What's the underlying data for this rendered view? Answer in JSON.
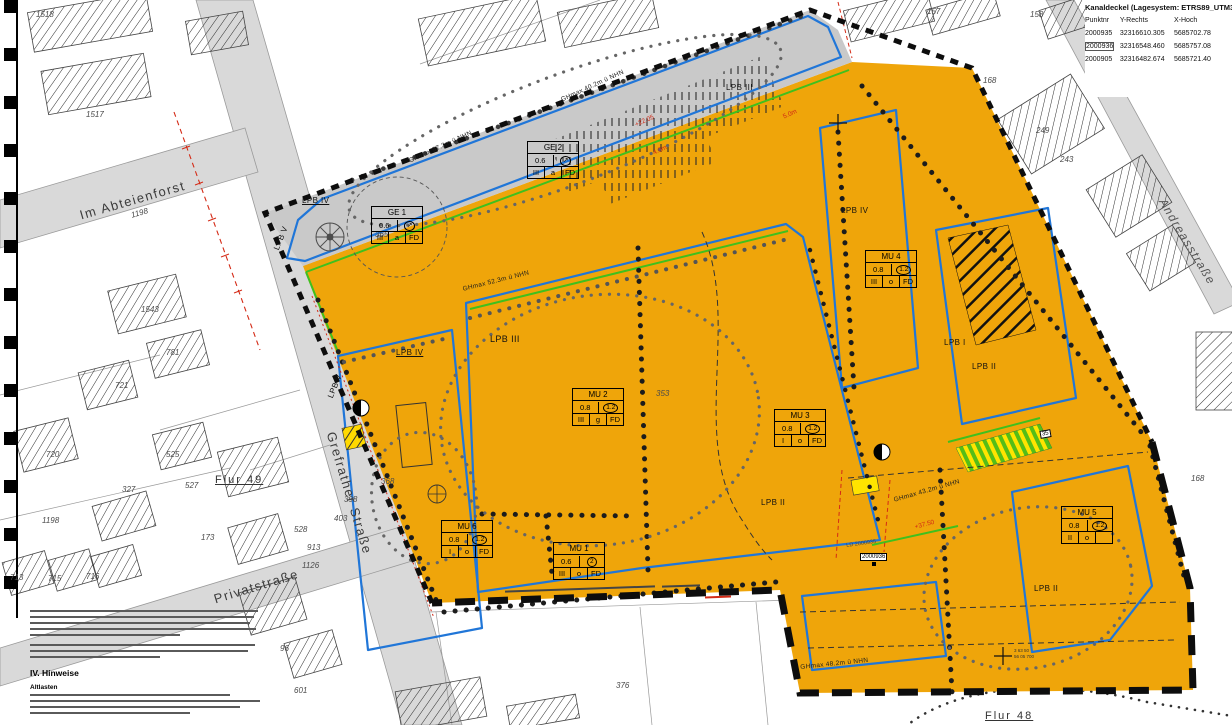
{
  "kanaldeckel": {
    "title": "Kanaldeckel (Lagesystem: ETRS89_UTM32)",
    "col_punkt": "Punktnr",
    "col_y": "Y-Rechts",
    "col_x": "X-Hoch",
    "rows": [
      {
        "p": "2000935",
        "y": "32316610.305",
        "x": "5685702.78"
      },
      {
        "p": "2000936",
        "y": "32316548.460",
        "x": "5685757.08"
      },
      {
        "p": "2000905",
        "y": "32316482.674",
        "x": "5685721.40"
      }
    ]
  },
  "streets": {
    "im_abteienforst": "Im Abteienforst",
    "grefrather": "Grefrather Straße",
    "privatstrasse": "Privatstraße",
    "andreasstrasse": "Andreasstraße"
  },
  "flur": {
    "f49": "Flur 49",
    "f48": "Flur 48"
  },
  "hinweise": {
    "heading": "IV. Hinweise",
    "sub": "Altlasten"
  },
  "zone_boxes": {
    "ge1": {
      "name": "GE 1",
      "v1": "0.6",
      "v2": "↗",
      "b1": "III",
      "b2": "a",
      "b3": "FD"
    },
    "ge2": {
      "name": "GE 2",
      "v1": "0.6",
      "v2": "↗",
      "b1": "III",
      "b2": "a",
      "b3": "FD"
    },
    "mu1": {
      "name": "MU 1",
      "v1": "0.6",
      "v2": "2",
      "b1": "III",
      "b2": "o",
      "b3": "FD"
    },
    "mu2": {
      "name": "MU 2",
      "v1": "0.8",
      "v2": "1.2",
      "b1": "III",
      "b2": "g",
      "b3": "FD"
    },
    "mu3": {
      "name": "MU 3",
      "v1": "0.8",
      "v2": "1.2",
      "b1": "I",
      "b2": "o",
      "b3": "FD"
    },
    "mu4": {
      "name": "MU 4",
      "v1": "0.8",
      "v2": "1.2",
      "b1": "III",
      "b2": "o",
      "b3": "FD"
    },
    "mu5": {
      "name": "MU 5",
      "v1": "0.8",
      "v2": "1.2",
      "b1": "II",
      "b2": "o",
      "b3": ""
    },
    "mu6": {
      "name": "MU 6",
      "v1": "0.8",
      "v2": "1.2",
      "b1": "I",
      "b2": "o",
      "b3": "FD"
    }
  },
  "area_labels": [
    "LPB IV",
    "LPB V",
    "LPB III",
    "LPB IV",
    "LPB V",
    "LPB III",
    "LPB IV",
    "LPB I",
    "LPB II",
    "LPB II",
    "LPB II"
  ],
  "height_labels": [
    "GHmax 57.3m ü NHN",
    "GHmax 40.2m ü NHN",
    "GHmax 52.3m ü NHN",
    "GHmax 43.2m ü NHN",
    "GHmax 48.2m ü NHN"
  ],
  "red_labels": [
    "+22.05",
    "4.0m",
    "+37.50",
    "5.0m"
  ],
  "parcels": [
    "1518",
    "1517",
    "1543",
    "781",
    "721",
    "720",
    "525",
    "327",
    "1198",
    "713",
    "715",
    "716",
    "96",
    "601",
    "368",
    "365",
    "527",
    "528",
    "913",
    "1126",
    "173",
    "403",
    "398",
    "376",
    "353",
    "1198",
    "157",
    "158",
    "168",
    "249",
    "243",
    "168"
  ],
  "cross_label": {
    "l1": "3 63 50",
    "l2": "56 05 700"
  },
  "point_marker": {
    "ld": "LD 2000935",
    "num": "2000936"
  },
  "misc": {
    "box35": "35"
  }
}
